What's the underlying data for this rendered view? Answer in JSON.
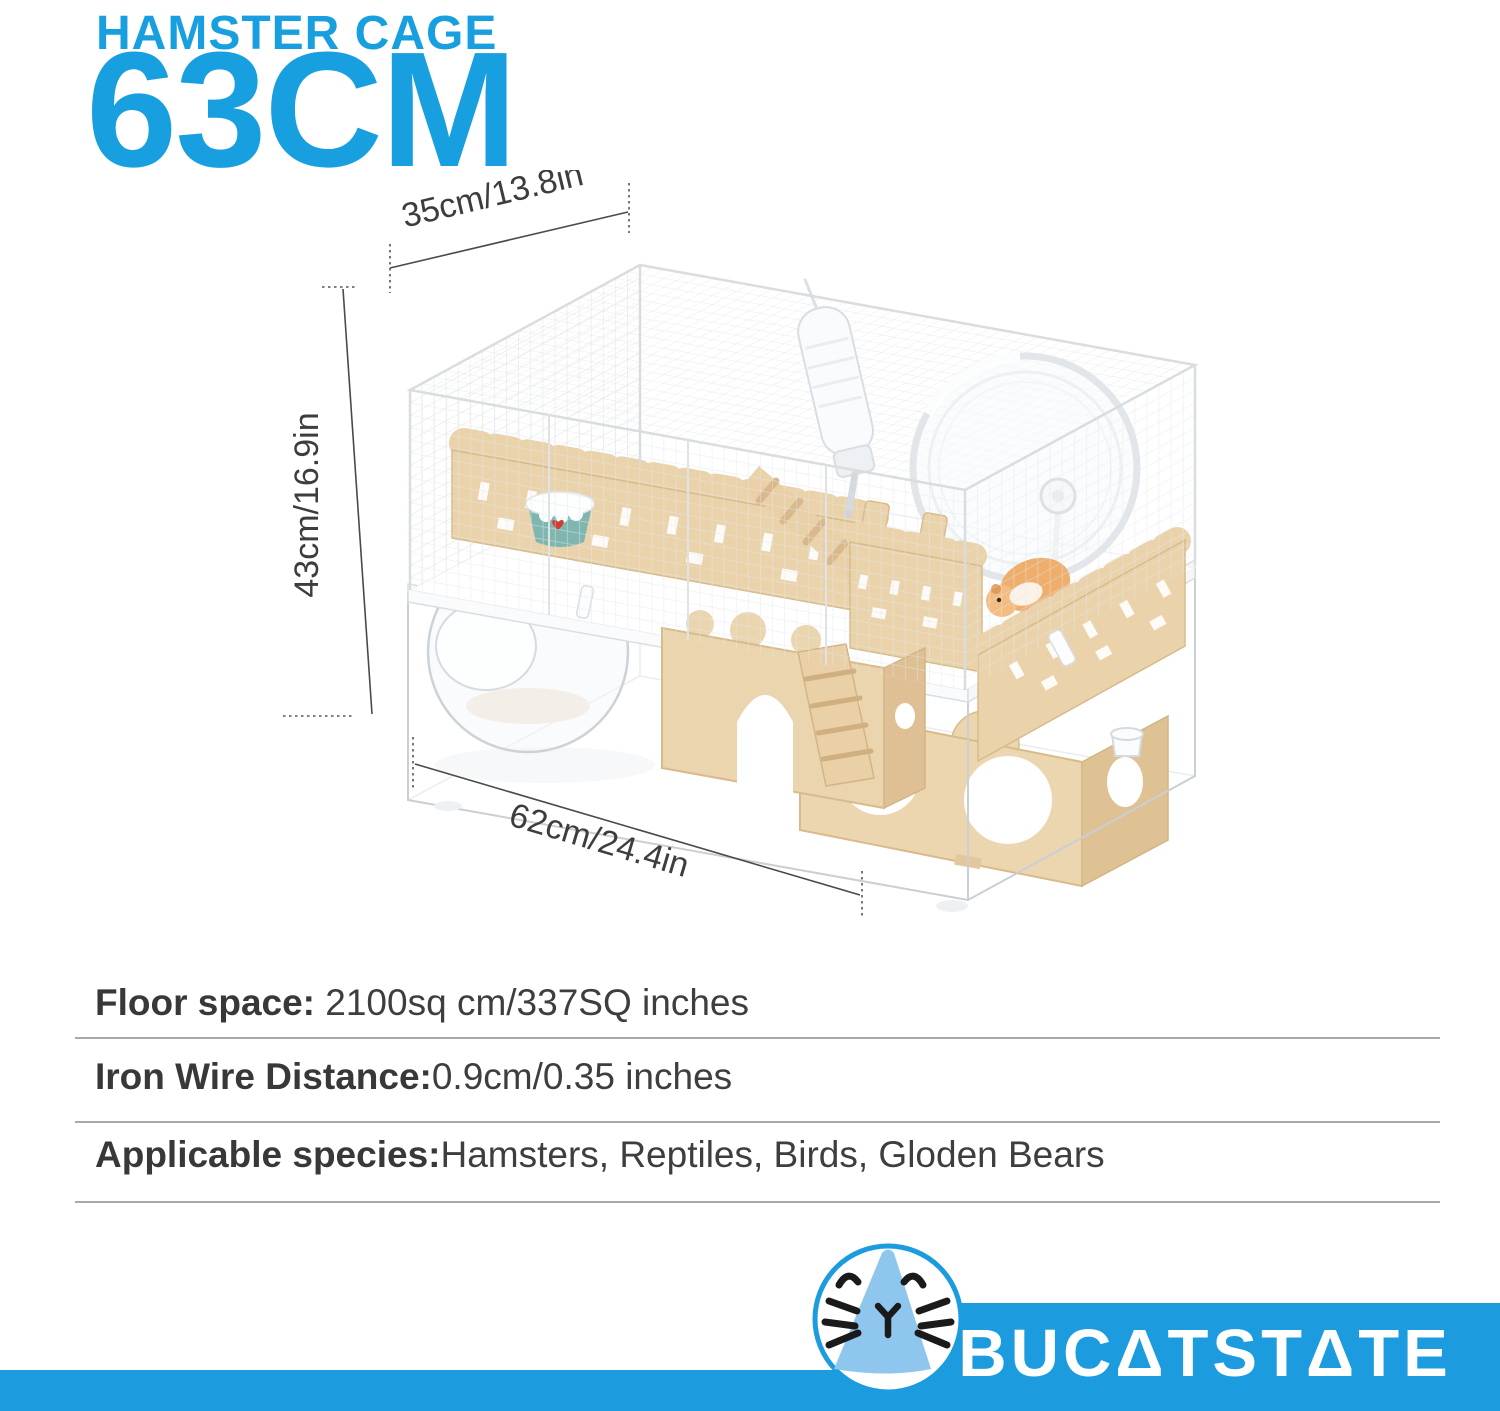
{
  "title": {
    "line1": "HAMSTER CAGE",
    "line2": "63CM"
  },
  "dimensions": {
    "depth_top": "35cm/13.8in",
    "height_left": "43cm/16.9in",
    "width_bottom": "62cm/24.4in"
  },
  "specs": [
    {
      "label": "Floor space:",
      "value": " 2100sq cm/337SQ inches"
    },
    {
      "label": "Iron Wire Distance:",
      "value": "0.9cm/0.35 inches"
    },
    {
      "label": "Applicable species:",
      "value": "Hamsters, Reptiles, Birds, Gloden Bears"
    }
  ],
  "brand": {
    "name": "BUCATSTATE",
    "display": "BUCΔTSTΔTE"
  },
  "colors": {
    "accent_blue": "#189FE0",
    "banner_blue": "#1C9CDF",
    "logo_light_blue": "#8FC6ED",
    "wood_tan": "#EAD3AB",
    "bowl_teal": "#7FB7B0",
    "dim_line_gray": "#4A4A4A",
    "spec_text_gray": "#3E3E3E"
  }
}
